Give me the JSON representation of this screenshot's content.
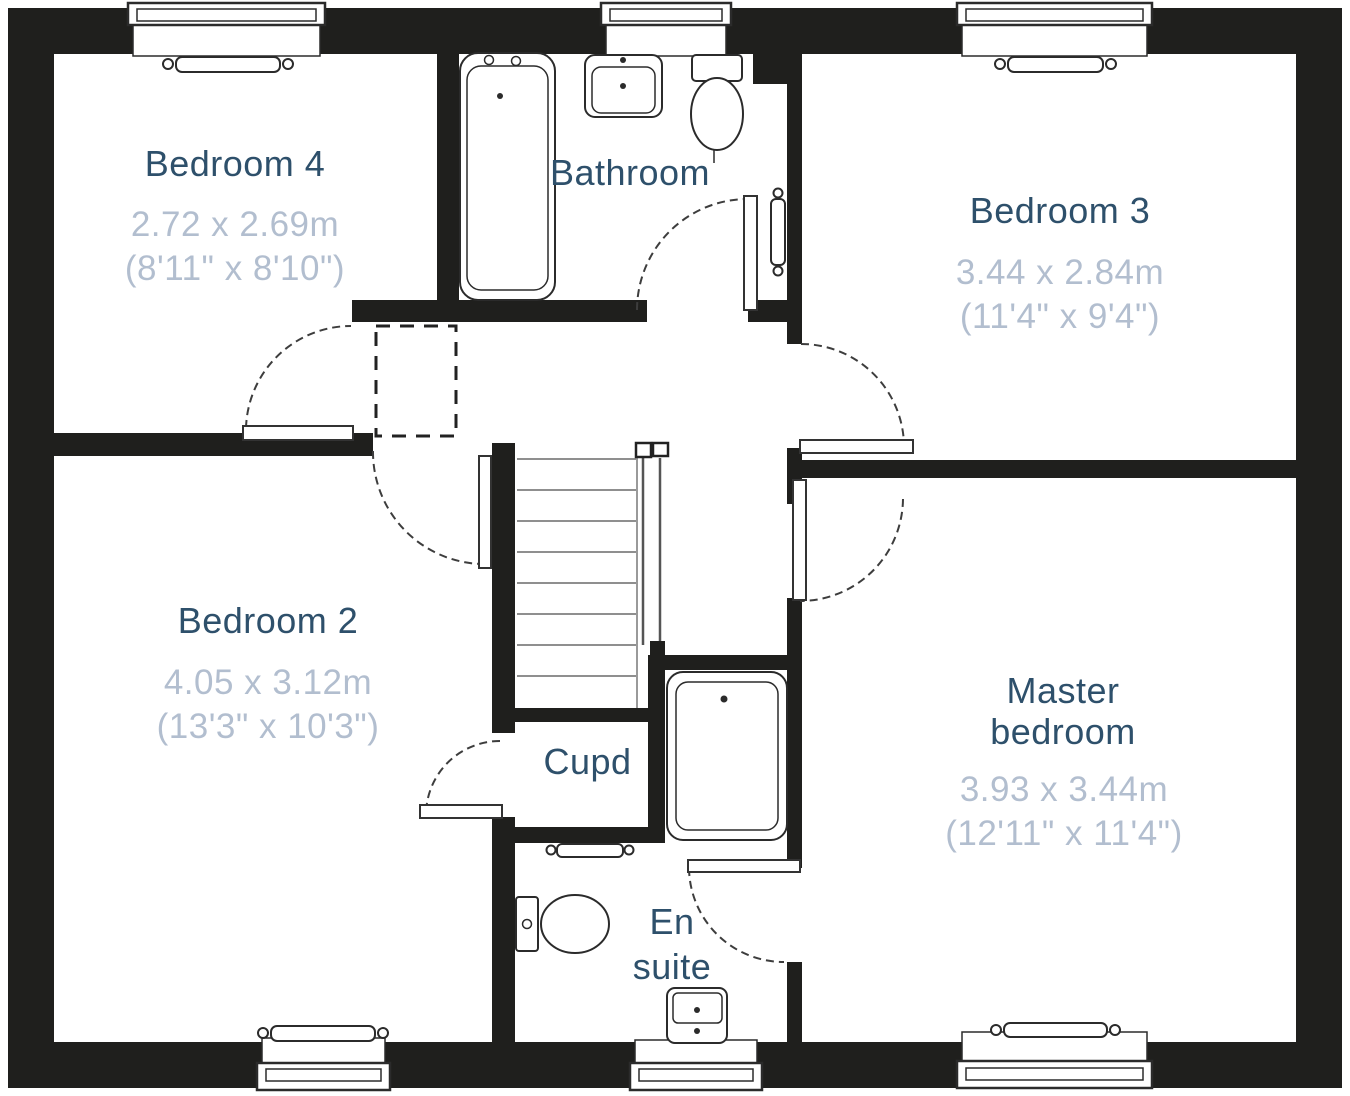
{
  "colors": {
    "wall": "#1f1f1d",
    "room_name": "#2e506b",
    "dimensions_text": "#b2becf",
    "fixture_line": "#2b2b2b"
  },
  "rooms": {
    "bedroom4": {
      "name": "Bedroom 4",
      "metric": "2.72 x 2.69m",
      "imperial": "(8'11\" x 8'10\")"
    },
    "bathroom": {
      "name": "Bathroom"
    },
    "bedroom3": {
      "name": "Bedroom 3",
      "metric": "3.44 x 2.84m",
      "imperial": "(11'4\" x 9'4\")"
    },
    "bedroom2": {
      "name": "Bedroom 2",
      "metric": "4.05 x 3.12m",
      "imperial": "(13'3\" x 10'3\")"
    },
    "cupboard": {
      "name": "Cupd"
    },
    "ensuite": {
      "name": "En suite"
    },
    "master": {
      "name": "Master bedroom",
      "metric": "3.93 x 3.44m",
      "imperial": "(12'11\" x 11'4\")"
    }
  }
}
